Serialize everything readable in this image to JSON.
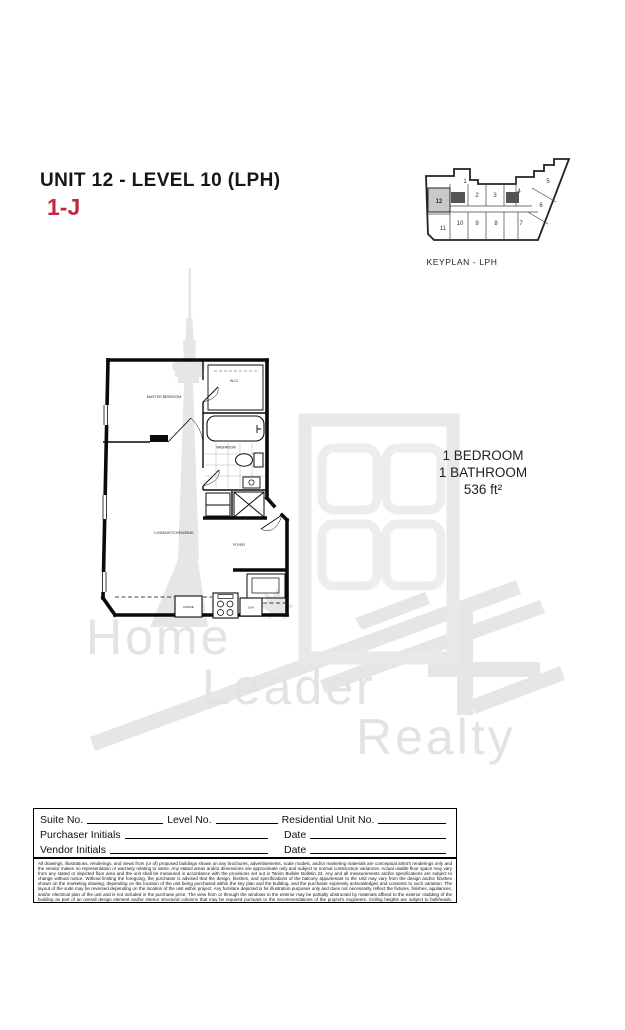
{
  "page": {
    "title": "UNIT 12 - LEVEL 10 (LPH)",
    "unit_code": "1-J"
  },
  "colors": {
    "accent_red": "#c22a3c",
    "watermark_gray": "#e3e3e3",
    "keyplan_highlight": "#c9c9c9",
    "plan_line": "#0a0a0a"
  },
  "keyplan": {
    "caption": "KEYPLAN - LPH",
    "highlighted_unit": "12",
    "units": {
      "u1": "1",
      "u2": "2",
      "u3": "3",
      "u4": "4",
      "u5": "5",
      "u6": "6",
      "u7": "7",
      "u8": "8",
      "u9": "9",
      "u10": "10",
      "u11": "11",
      "u12": "12"
    }
  },
  "floorplan": {
    "rooms": {
      "master_bedroom": "MASTER BEDROOM",
      "wic": "W.I.C",
      "washroom": "WASHROOM",
      "living": "LIVING/KITCHEN/DINE",
      "foyer": "FOYER"
    },
    "fixtures": {
      "fridge": "FRIDGE",
      "dishwasher": "D/W"
    }
  },
  "unit_stats": {
    "bedrooms": "1 BEDROOM",
    "bathrooms": "1 BATHROOM",
    "area": "536 ft²"
  },
  "watermark": {
    "word1": "Home",
    "word2": "Leader",
    "word3": "Realty"
  },
  "form": {
    "suite_label": "Suite No.",
    "level_label": "Level No.",
    "residential_label": "Residential Unit No.",
    "purchaser_label": "Purchaser Initials",
    "vendor_label": "Vendor Initials",
    "date_label1": "Date",
    "date_label2": "Date"
  },
  "disclaimer": "All drawings, illustrations, renderings, and views from (or of) proposed buildings shown on any brochures, advertisements, scale models, and/or marketing materials are conceptual artist's renderings only and the vendor makes no representation or warranty relating to same. Any stated areas and/or dimensions are approximate only and subject to normal construction variances. Actual usable floor space may vary from any stated or depicted floor area and the unit shall be measured in accordance with the provisions set out in Tarion Builder Bulletin 22. Any and all measurements and/or specifications are subject to change without notice. Without limiting the foregoing, the purchaser is advised that the design, finishes, and specifications of the balcony appurtenant to the Unit may vary from the design and/or finishes shown on the marketing drawing, depending on the location of the unit being purchased within the key plan and the building, and the purchaser expressly acknowledges and consents to such variation. The layout of the suite may be reversed depending on the location of the unit within project. Any furniture depicted is for illustration purposes only and does not necessarily reflect the fixtures, finishes, appliances, and/or electrical plan of the unit and is not included in the purchase price. The view from or through the windows to the exterior may be partially obstructed by materials affixed to the exterior cladding of the building as part of an overall design element and/or interior structural columns that may be required pursuant to the recommendations of the project's engineers. Ceiling heights are subject to bulkheads, exposed ducts, dropped ceilings and structural beams, as applicable pursuant to the plans. All features and finishes are subject to change without notice. E.&O.E September 2020."
}
